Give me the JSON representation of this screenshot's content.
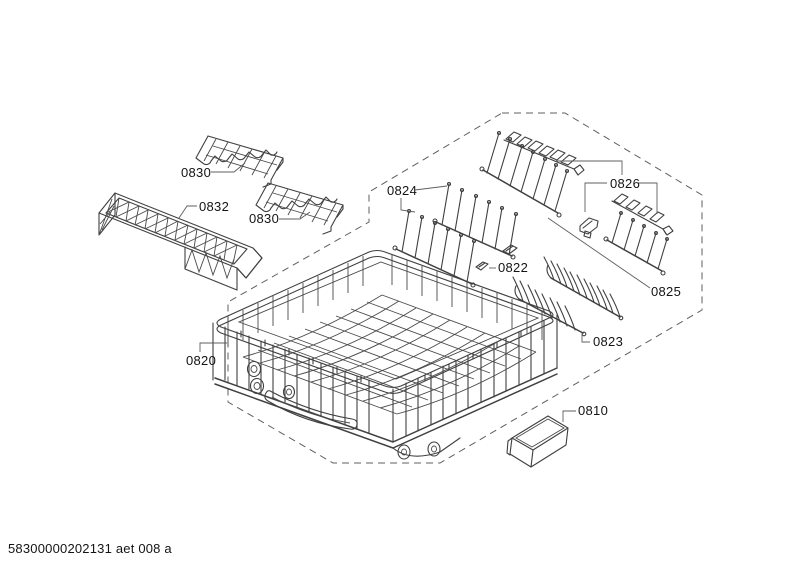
{
  "diagram": {
    "type": "exploded-parts-diagram",
    "part_numbers": [
      "0810",
      "0820",
      "0822",
      "0823",
      "0824",
      "0825",
      "0826",
      "0830",
      "0832"
    ],
    "labels": {
      "part_0830_a": "0830",
      "part_0832": "0832",
      "part_0830_b": "0830",
      "part_0824": "0824",
      "part_0826": "0826",
      "part_0825": "0825",
      "part_0822": "0822",
      "part_0823": "0823",
      "part_0820": "0820",
      "part_0810": "0810"
    },
    "footer_code": "58300000202131 aet 008 a",
    "colors": {
      "line": "#404040",
      "label_text": "#141414",
      "background": "#ffffff"
    }
  }
}
